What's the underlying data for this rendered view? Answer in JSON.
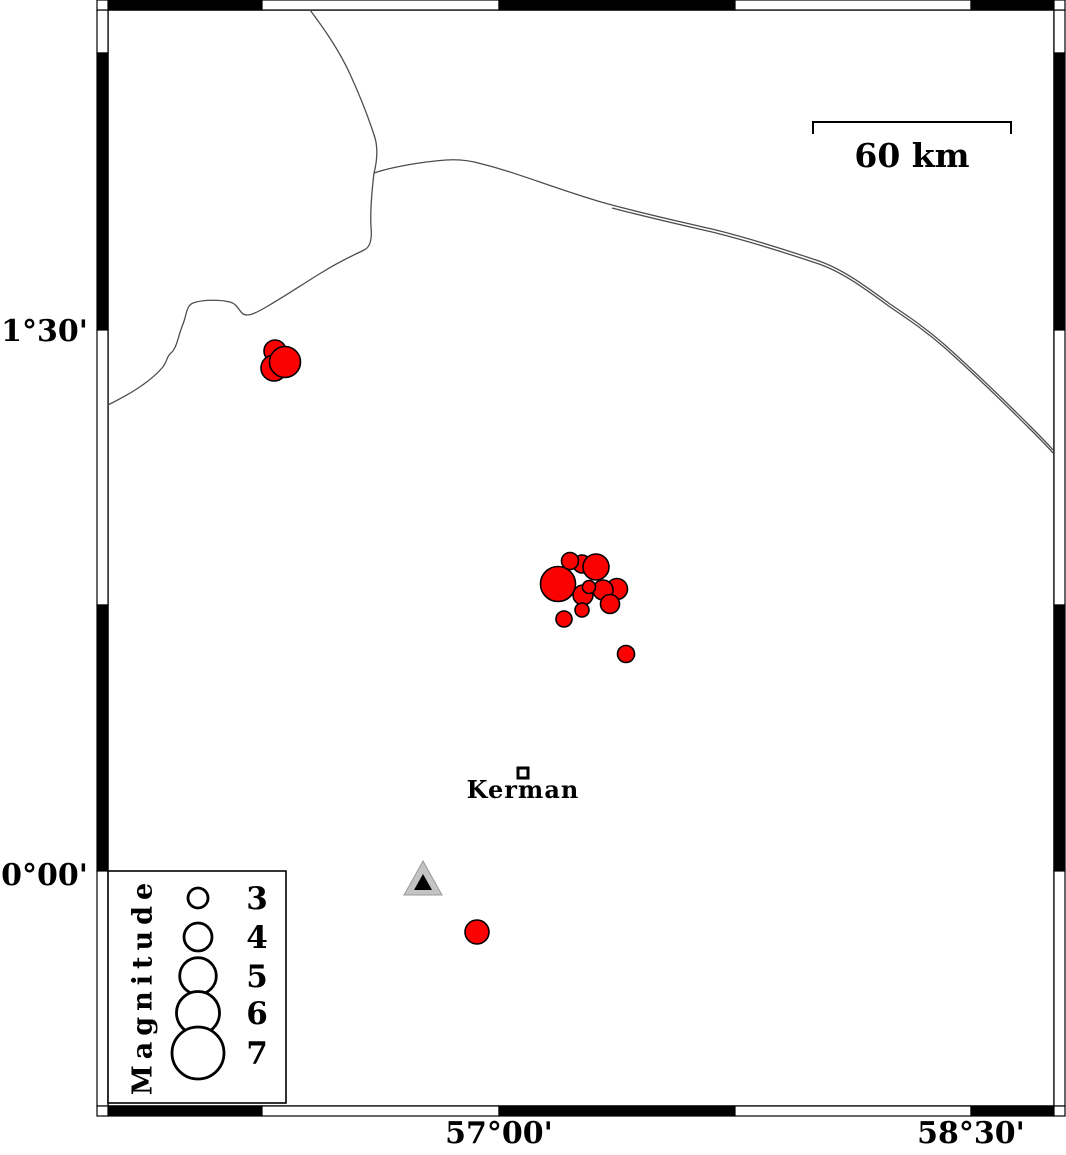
{
  "map": {
    "axis": {
      "left": [
        {
          "text": "31°30'"
        },
        {
          "text": "30°00'"
        }
      ],
      "bottom": [
        {
          "text": "57°00'"
        },
        {
          "text": "58°30'"
        }
      ]
    },
    "scale_bar": {
      "label": "60 km"
    },
    "city": {
      "label": "Kerman"
    },
    "station": {
      "symbol": "triangle"
    },
    "colors": {
      "quake": "#fa0202",
      "road": "#4d4d4d",
      "triangle_outer": "#c3c3c3",
      "triangle_inner": "#000000",
      "frame_black": "#000000",
      "frame_white": "#ffffff"
    },
    "roads": [
      {
        "d": "M310,10 C322,26 338,48 350,74 C360,96 370,122 375,138 C378,148 377,162 374,173"
      },
      {
        "d": "M108,405 C126,396 148,384 162,368 C168,361 166,357 171,353 C177,348 178,336 183,324 C187,314 186,306 193,303 C204,299 222,300 230,302 C237,304 238,309 242,313 C247,318 256,313 268,306 C290,293 306,282 321,273 C340,261 354,255 364,250 C371,247 372,237 371,227 C370,210 372,190 374,173"
      },
      {
        "d": "M374,173 C392,167 420,162 446,160 C461,159 472,161 482,164 C490,166 494,167 500,169 C522,175 560,190 601,202 C640,213 682,222 716,230 C752,239 792,252 816,260 C841,268 864,285 890,304 C906,315 922,325 945,345 C974,371 1008,404 1031,427 C1041,437 1048,444 1053,450"
      },
      {
        "d": "M612,208 C650,218 686,226 716,233 C752,242 792,255 816,263 C841,271 864,288 890,307 C906,318 922,328 945,348 C974,374 1008,407 1031,430 C1041,440 1048,447 1053,453"
      }
    ],
    "earthquakes": [
      {
        "x": 275,
        "y": 351,
        "r": 11
      },
      {
        "x": 274,
        "y": 368,
        "r": 13
      },
      {
        "x": 285,
        "y": 362,
        "r": 15.5
      },
      {
        "x": 582,
        "y": 564,
        "r": 9
      },
      {
        "x": 570,
        "y": 561,
        "r": 8.5
      },
      {
        "x": 596,
        "y": 567,
        "r": 13
      },
      {
        "x": 558,
        "y": 584,
        "r": 17.5
      },
      {
        "x": 617,
        "y": 589,
        "r": 10.5
      },
      {
        "x": 603,
        "y": 590,
        "r": 10
      },
      {
        "x": 610,
        "y": 604,
        "r": 9.5
      },
      {
        "x": 583,
        "y": 595,
        "r": 10
      },
      {
        "x": 582,
        "y": 610,
        "r": 7
      },
      {
        "x": 564,
        "y": 619,
        "r": 8
      },
      {
        "x": 589,
        "y": 587,
        "r": 6.5
      },
      {
        "x": 626,
        "y": 654,
        "r": 8.5
      },
      {
        "x": 477,
        "y": 932,
        "r": 12
      }
    ]
  },
  "legend": {
    "title": "Magnitude",
    "items": [
      {
        "label": "3",
        "radius": 10
      },
      {
        "label": "4",
        "radius": 14
      },
      {
        "label": "5",
        "radius": 18.3
      },
      {
        "label": "6",
        "radius": 21.5
      },
      {
        "label": "7",
        "radius": 26
      }
    ]
  }
}
